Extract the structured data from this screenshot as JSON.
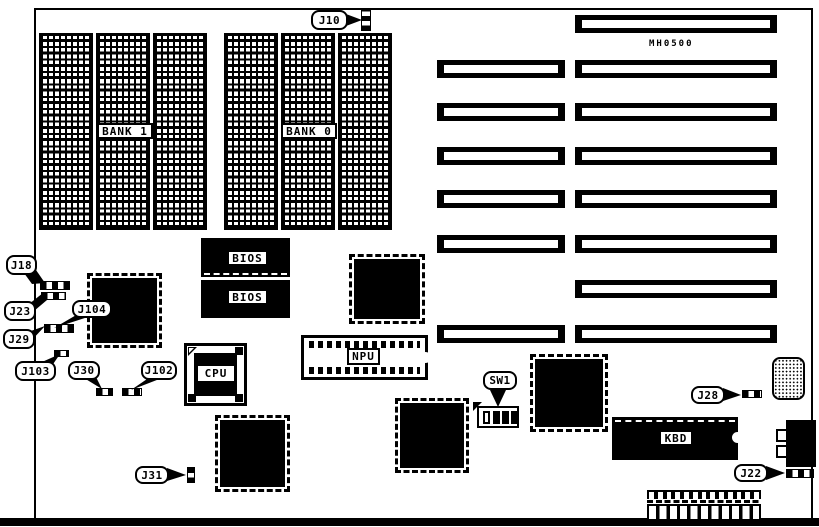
{
  "board": {
    "model": "MH0500",
    "bank1_label": "BANK 1",
    "bank0_label": "BANK 0",
    "bios1_label": "BIOS",
    "bios2_label": "BIOS",
    "npu_label": "NPU",
    "cpu_label": "CPU",
    "kbd_label": "KBD",
    "callouts": {
      "j10": "J10",
      "j18": "J18",
      "j23": "J23",
      "j29": "J29",
      "j103": "J103",
      "j104": "J104",
      "j30": "J30",
      "j102": "J102",
      "j31": "J31",
      "sw1": "SW1",
      "j28": "J28",
      "j22": "J22"
    }
  }
}
